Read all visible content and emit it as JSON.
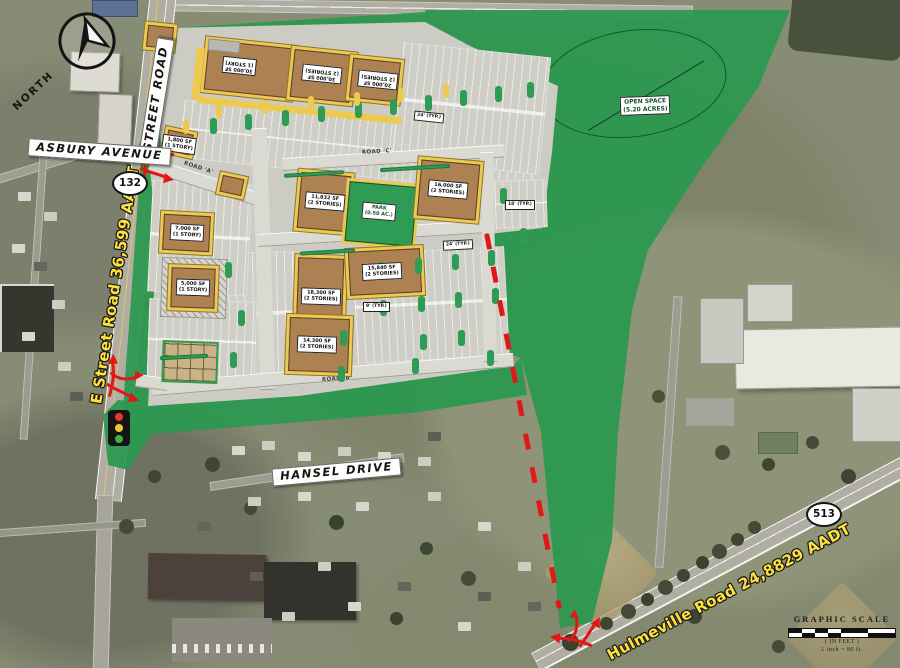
{
  "map": {
    "compass": {
      "label": "NORTH"
    },
    "street_banners": {
      "street_road": "STREET ROAD",
      "asbury_avenue": "ASBURY AVENUE",
      "hansel_drive": "HANSEL DRIVE"
    },
    "traffic_labels": {
      "e_street_road": "E Street Road 36,599 AADT",
      "hulmeville_road": "Hulmeville Road 24,8829 AADT"
    },
    "route_shields": {
      "street_road": "132",
      "hulmeville_road": "513"
    },
    "open_space": {
      "line1": "OPEN SPACE",
      "line2": "(5.20 ACRES)"
    },
    "park_label": {
      "line1": "PARK",
      "line2": "(0.50 AC.)"
    },
    "internal_roads": {
      "a": "ROAD 'A'",
      "b": "ROAD 'B'",
      "c": "ROAD 'C'",
      "d": "ROAD 'D'"
    },
    "buildings": [
      {
        "id": "anchor-1",
        "line1": "30,000 SF",
        "line2": "(1 STORY)"
      },
      {
        "id": "anchor-2",
        "line1": "30,000 SF",
        "line2": "(2 STORIES)"
      },
      {
        "id": "anchor-3",
        "line1": "20,000 SF",
        "line2": "(2 STORIES)"
      },
      {
        "id": "pad-entrance",
        "line1": "1,800 SF",
        "line2": "(1 STORY)"
      },
      {
        "id": "pad-west-1",
        "line1": "7,000 SF",
        "line2": "(1 STORY)"
      },
      {
        "id": "pad-west-2",
        "line1": "5,000 SF",
        "line2": "(1 STORY)"
      },
      {
        "id": "center-1",
        "line1": "11,832 SF",
        "line2": "(2 STORIES)"
      },
      {
        "id": "center-2",
        "line1": "16,000 SF",
        "line2": "(2 STORIES)"
      },
      {
        "id": "south-1",
        "line1": "18,300 SF",
        "line2": "(2 STORIES)"
      },
      {
        "id": "south-2",
        "line1": "15,840 SF",
        "line2": "(2 STORIES)"
      },
      {
        "id": "south-3",
        "line1": "14,300 SF",
        "line2": "(2 STORIES)"
      }
    ],
    "dimension_notes": [
      "24' (TYP.)",
      "18' (TYP.)",
      "24' (TYP.)",
      "9' (TYP.)"
    ],
    "graphic_scale": {
      "title": "GRAPHIC SCALE",
      "units": "( IN FEET )",
      "ratio": "1 inch = 80 ft."
    },
    "colors": {
      "overlay_green": "#2c9850",
      "building_brown": "#ad8152",
      "sidewalk_yellow": "#ecca52",
      "red_accent": "#e01818",
      "aadt_text": "#ffe23c"
    }
  }
}
